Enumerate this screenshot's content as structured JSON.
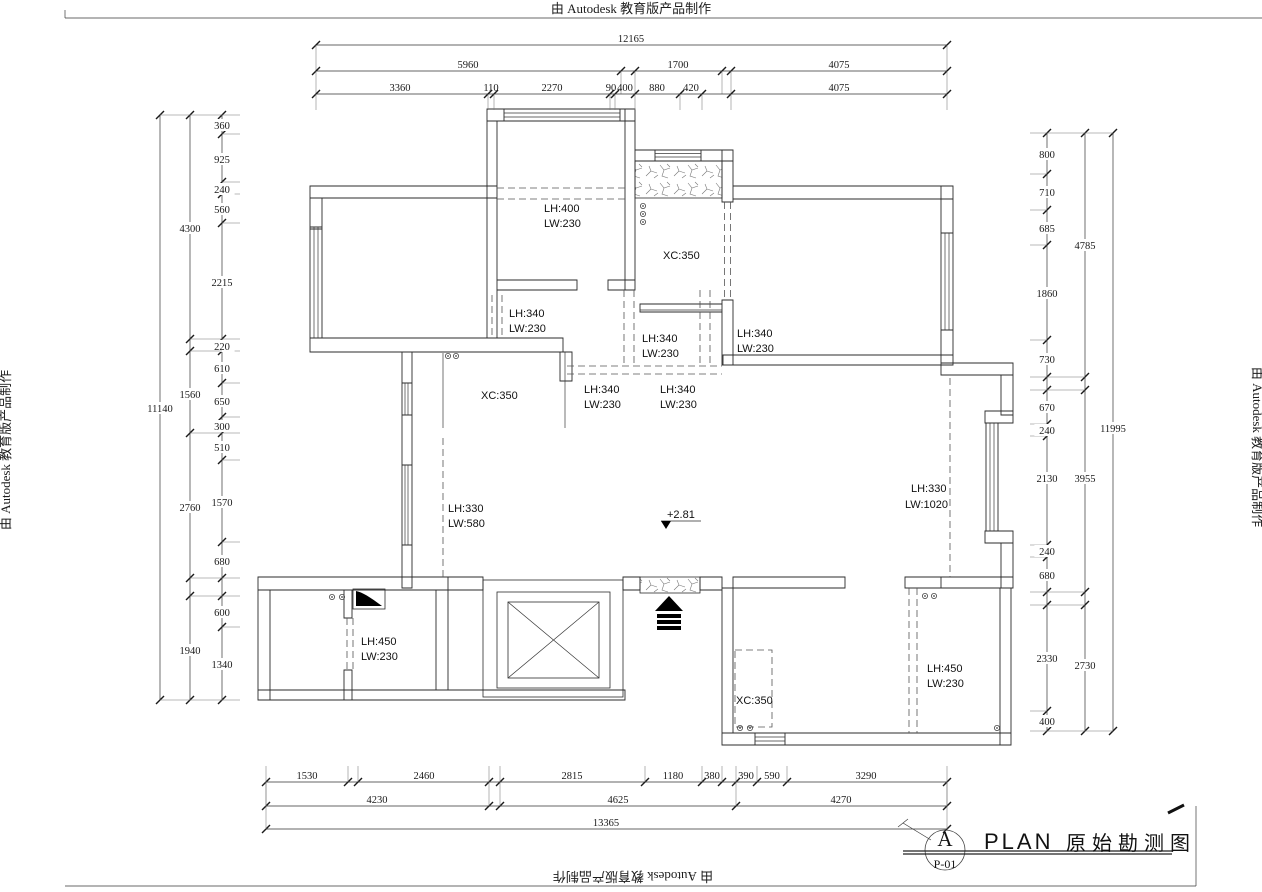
{
  "watermark": {
    "text": "由 Autodesk 教育版产品制作"
  },
  "title_block": {
    "detail_letter": "A",
    "sheet_number": "P-01",
    "plan_label": "PLAN",
    "plan_title": "原始勘测图"
  },
  "elevation_marker": {
    "value": "+2.81"
  },
  "plan_labels": [
    {
      "t": "LH:400",
      "x": 544,
      "y": 212
    },
    {
      "t": "LW:230",
      "x": 544,
      "y": 227
    },
    {
      "t": "XC:350",
      "x": 663,
      "y": 259
    },
    {
      "t": "LH:340",
      "x": 509,
      "y": 317
    },
    {
      "t": "LW:230",
      "x": 509,
      "y": 332
    },
    {
      "t": "LH:340",
      "x": 642,
      "y": 342
    },
    {
      "t": "LW:230",
      "x": 642,
      "y": 357
    },
    {
      "t": "LH:340",
      "x": 737,
      "y": 337
    },
    {
      "t": "LW:230",
      "x": 737,
      "y": 352
    },
    {
      "t": "LH:340",
      "x": 584,
      "y": 393
    },
    {
      "t": "LW:230",
      "x": 584,
      "y": 408
    },
    {
      "t": "LH:340",
      "x": 660,
      "y": 393
    },
    {
      "t": "LW:230",
      "x": 660,
      "y": 408
    },
    {
      "t": "XC:350",
      "x": 481,
      "y": 399
    },
    {
      "t": "LH:330",
      "x": 448,
      "y": 512
    },
    {
      "t": "LW:580",
      "x": 448,
      "y": 527
    },
    {
      "t": "LH:330",
      "x": 911,
      "y": 492
    },
    {
      "t": "LW:1020",
      "x": 905,
      "y": 508
    },
    {
      "t": "+2.81",
      "x": 667,
      "y": 518
    },
    {
      "t": "LH:450",
      "x": 361,
      "y": 645
    },
    {
      "t": "LW:230",
      "x": 361,
      "y": 660
    },
    {
      "t": "XC:350",
      "x": 736,
      "y": 704
    },
    {
      "t": "LH:450",
      "x": 927,
      "y": 672
    },
    {
      "t": "LW:230",
      "x": 927,
      "y": 687
    }
  ],
  "dim_chains": [
    {
      "id": "top-overall",
      "dir": "h",
      "pos": 45,
      "ext": 26,
      "ticks": [
        316,
        947
      ],
      "labels": [
        {
          "t": "12165",
          "p": 631
        }
      ]
    },
    {
      "id": "top-mid",
      "dir": "h",
      "pos": 71,
      "ext": 23,
      "ticks": [
        316,
        621,
        635,
        722,
        731,
        947
      ],
      "labels": [
        {
          "t": "5960",
          "p": 468
        },
        {
          "t": "1700",
          "p": 678
        },
        {
          "t": "4075",
          "p": 839
        }
      ]
    },
    {
      "id": "top-inner",
      "dir": "h",
      "pos": 94,
      "ext": 16,
      "ticks": [
        316,
        488,
        494,
        610,
        615,
        635,
        680,
        702,
        731,
        947
      ],
      "labels": [
        {
          "t": "3360",
          "p": 400
        },
        {
          "t": "110",
          "p": 491
        },
        {
          "t": "2270",
          "p": 552
        },
        {
          "t": "90",
          "p": 611
        },
        {
          "t": "400",
          "p": 625
        },
        {
          "t": "880",
          "p": 657
        },
        {
          "t": "420",
          "p": 691
        },
        {
          "t": "4075",
          "p": 839
        }
      ]
    },
    {
      "id": "bottom-inner",
      "dir": "h",
      "pos": 782,
      "ext": -16,
      "ticks": [
        266,
        348,
        358,
        489,
        500,
        645,
        702,
        722,
        736,
        757,
        787,
        947
      ],
      "labels": [
        {
          "t": "1530",
          "p": 307
        },
        {
          "t": "2460",
          "p": 424
        },
        {
          "t": "2815",
          "p": 572
        },
        {
          "t": "1180",
          "p": 673
        },
        {
          "t": "380",
          "p": 712
        },
        {
          "t": "390",
          "p": 746
        },
        {
          "t": "590",
          "p": 772
        },
        {
          "t": "3290",
          "p": 866
        }
      ]
    },
    {
      "id": "bottom-mid",
      "dir": "h",
      "pos": 806,
      "ext": -24,
      "ticks": [
        266,
        489,
        500,
        736,
        947
      ],
      "labels": [
        {
          "t": "4230",
          "p": 377
        },
        {
          "t": "4625",
          "p": 618
        },
        {
          "t": "4270",
          "p": 841
        }
      ]
    },
    {
      "id": "bottom-overall",
      "dir": "h",
      "pos": 829,
      "ext": -47,
      "ticks": [
        266,
        947
      ],
      "labels": [
        {
          "t": "13365",
          "p": 606
        }
      ]
    },
    {
      "id": "left-inner",
      "dir": "v",
      "pos": 222,
      "ext": 18,
      "ticks": [
        115,
        134,
        182,
        194,
        223,
        339,
        351,
        383,
        417,
        433,
        460,
        542,
        578,
        596,
        627,
        700
      ],
      "labels": [
        {
          "t": "360",
          "p": 125
        },
        {
          "t": "925",
          "p": 159
        },
        {
          "t": "240",
          "p": 189
        },
        {
          "t": "560",
          "p": 209
        },
        {
          "t": "2215",
          "p": 282
        },
        {
          "t": "220",
          "p": 346
        },
        {
          "t": "610",
          "p": 368
        },
        {
          "t": "650",
          "p": 401
        },
        {
          "t": "300",
          "p": 426
        },
        {
          "t": "510",
          "p": 447
        },
        {
          "t": "1570",
          "p": 502
        },
        {
          "t": "680",
          "p": 561
        },
        {
          "t": "600",
          "p": 612
        },
        {
          "t": "1340",
          "p": 664
        }
      ]
    },
    {
      "id": "left-mid",
      "dir": "v",
      "pos": 190,
      "ext": 32,
      "ticks": [
        115,
        339,
        351,
        433,
        578,
        596,
        700
      ],
      "labels": [
        {
          "t": "4300",
          "p": 228
        },
        {
          "t": "1560",
          "p": 394
        },
        {
          "t": "2760",
          "p": 507
        },
        {
          "t": "1940",
          "p": 650
        }
      ]
    },
    {
      "id": "left-outer",
      "dir": "v",
      "pos": 160,
      "ext": 30,
      "ticks": [
        115,
        700
      ],
      "labels": [
        {
          "t": "11140",
          "p": 408
        }
      ]
    },
    {
      "id": "right-inner",
      "dir": "v",
      "pos": 1047,
      "ext": -17,
      "ticks": [
        133,
        174,
        210,
        245,
        340,
        377,
        390,
        424,
        436,
        545,
        557,
        592,
        605,
        711,
        731
      ],
      "labels": [
        {
          "t": "800",
          "p": 154
        },
        {
          "t": "710",
          "p": 192
        },
        {
          "t": "685",
          "p": 228
        },
        {
          "t": "1860",
          "p": 293
        },
        {
          "t": "730",
          "p": 359
        },
        {
          "t": "670",
          "p": 407
        },
        {
          "t": "240",
          "p": 430
        },
        {
          "t": "2130",
          "p": 478
        },
        {
          "t": "240",
          "p": 551
        },
        {
          "t": "680",
          "p": 575
        },
        {
          "t": "2330",
          "p": 658
        },
        {
          "t": "400",
          "p": 721
        }
      ]
    },
    {
      "id": "right-mid",
      "dir": "v",
      "pos": 1085,
      "ext": -38,
      "ticks": [
        133,
        377,
        390,
        592,
        605,
        731
      ],
      "labels": [
        {
          "t": "4785",
          "p": 245
        },
        {
          "t": "3955",
          "p": 478
        },
        {
          "t": "2730",
          "p": 665
        }
      ]
    },
    {
      "id": "right-outer",
      "dir": "v",
      "pos": 1113,
      "ext": -28,
      "ticks": [
        133,
        731
      ],
      "labels": [
        {
          "t": "11995",
          "p": 428
        }
      ]
    }
  ]
}
